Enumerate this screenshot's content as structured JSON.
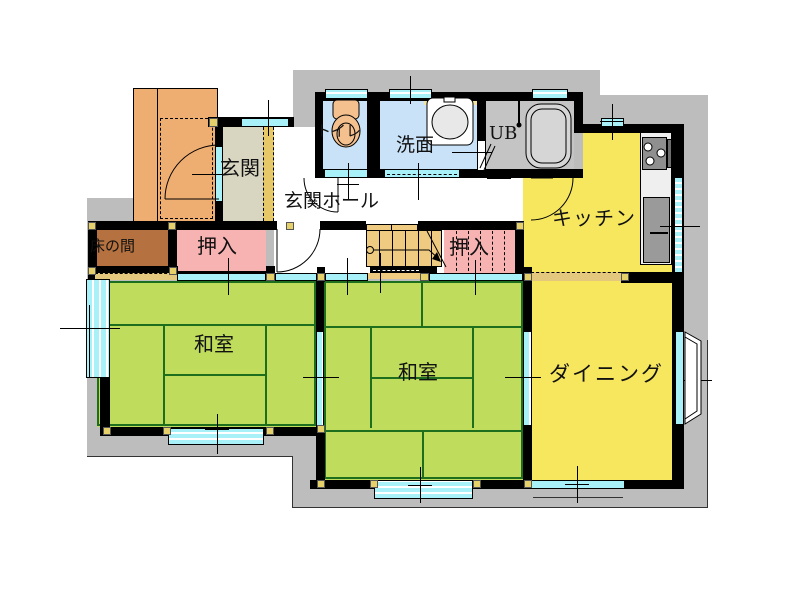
{
  "title": "1F間取り図",
  "labels": {
    "genkan": "玄関",
    "genkan_hall": "玄関ホール",
    "toilet": "トイレ",
    "washroom": "洗面",
    "unit_bath": "UB",
    "kitchen": "キッチン",
    "oshiire_left": "押入",
    "oshiire_right": "押入",
    "tokonoma": "床の間",
    "washitsu_left": "和室",
    "washitsu_center": "和室",
    "dining": "ダイニング"
  },
  "colors": {
    "silhouette": "#BDBDBD",
    "wall": "#000000",
    "tatami": "#BFDC5C",
    "tatami_line": "#1D6F1D",
    "flooring_yellow": "#F6E75F",
    "closet_pink": "#F7B2B2",
    "tokonoma_brown": "#B5713F",
    "porch_orange": "#EFAE71",
    "genkan_beige": "#D8D5C1",
    "step_tan": "#E7C869",
    "wet_area_blue": "#C9E2F7",
    "unit_bath_gray": "#C4C4C4",
    "window_cyan": "#A9F1F9",
    "stairs_tan": "#EFCB82",
    "counter_white": "#EFEFEF",
    "appliance_gray": "#8F8F8F",
    "corner_marker": "#E6D06A"
  },
  "fixtures": [
    "toilet",
    "wash-basin",
    "bathtub",
    "shower",
    "gas-stove",
    "kitchen-sink",
    "staircase",
    "bay-window"
  ]
}
